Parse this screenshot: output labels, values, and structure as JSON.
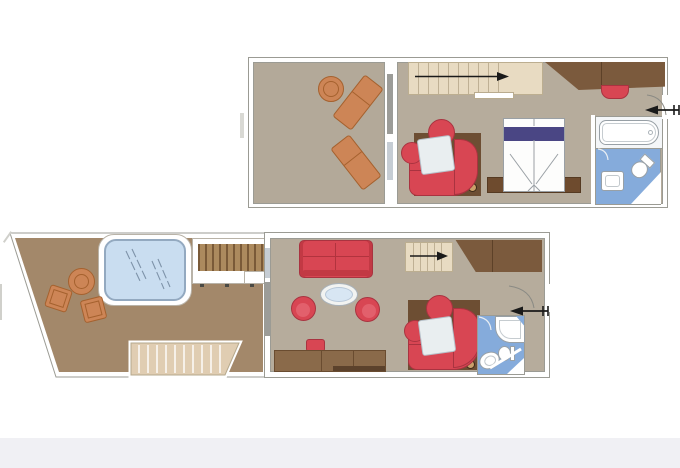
{
  "meta": {
    "kind": "duplex-suite-floor-plan",
    "levels": 2,
    "visible_text": "none"
  },
  "palette": {
    "wall_line": "#9b9b94",
    "floor": "#b6ac9c",
    "terrace": "#a3886a",
    "stair": "#e8dbc2",
    "stair_line": "#bfb094",
    "wood": "#7b5a3d",
    "wood_dark": "#5d4128",
    "console": "#8a6a4a",
    "mat": "#6d4e33",
    "red": "#d84653",
    "red_dark": "#a93340",
    "orange": "#cd8556",
    "orange_dark": "#a5612e",
    "pool": "#c9ddf0",
    "bath_blue": "#85abdb",
    "bed_band": "#4a4684",
    "table_blue": "#d8e6f3",
    "footer": "#f0f0f4",
    "arrow": "#1a1a1a"
  },
  "labels": {
    "plan_upper": "Upper level plan",
    "plan_lower": "Lower level plan",
    "terrace_upper": "Upper terrace",
    "terrace_lower": "Lower terrace",
    "lounger": "Sun lounger",
    "side_table": "Side table",
    "stairs": "Internal staircase",
    "wardrobe": "Wardrobe",
    "bench": "Bench",
    "entrance": "Entrance door",
    "bed": "Double bed",
    "nightstands": "Nightstand console",
    "dining_sofa": "Curved dining sofa",
    "dining_table": "Dining table",
    "bathtub": "Bathtub",
    "bathroom": "Bathroom",
    "shower": "Shower",
    "toilet": "Toilet",
    "sink": "Washbasin",
    "living_sofa": "Sofa",
    "coffee_table": "Coffee table",
    "armchair": "Armchair",
    "stool": "Stool",
    "desk": "Desk console",
    "whirlpool": "Whirlpool bath",
    "deck": "Wood decking",
    "deck_steps": "Terrace steps",
    "outdoor_table": "Outdoor table",
    "outdoor_chair": "Outdoor chair",
    "footer": "Footer bar"
  },
  "arrows": {
    "stair_direction": "right",
    "entry_direction": "left"
  }
}
